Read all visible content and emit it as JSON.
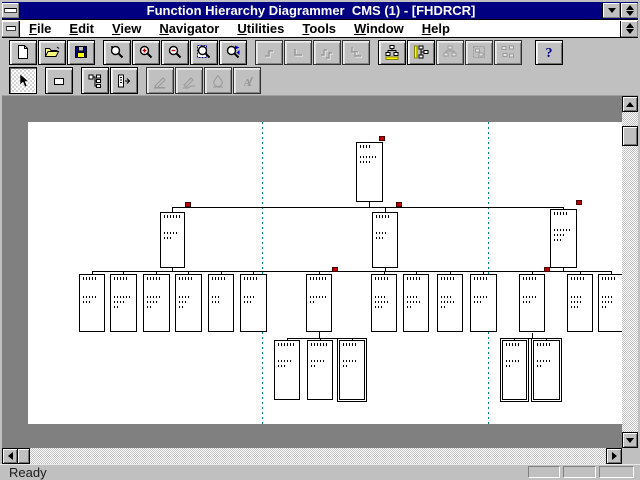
{
  "window": {
    "title": "Function Hierarchy Diagrammer  CMS (1) - [FHDRCR]"
  },
  "menu": {
    "items": [
      {
        "label": "File",
        "accel": 0
      },
      {
        "label": "Edit",
        "accel": 0
      },
      {
        "label": "View",
        "accel": 0
      },
      {
        "label": "Navigator",
        "accel": 0
      },
      {
        "label": "Utilities",
        "accel": 0
      },
      {
        "label": "Tools",
        "accel": 0
      },
      {
        "label": "Window",
        "accel": 0
      },
      {
        "label": "Help",
        "accel": 0
      }
    ]
  },
  "toolbar_row1": [
    {
      "name": "new",
      "icon": "doc-new",
      "enabled": true
    },
    {
      "name": "open",
      "icon": "folder-open",
      "enabled": true
    },
    {
      "name": "save",
      "icon": "floppy-save",
      "enabled": true
    },
    {
      "name": "zoom",
      "icon": "magnifier",
      "enabled": true,
      "gap": true
    },
    {
      "name": "zoom-in",
      "icon": "magnifier-plus",
      "enabled": true
    },
    {
      "name": "zoom-out",
      "icon": "magnifier-minus",
      "enabled": true
    },
    {
      "name": "zoom-page",
      "icon": "magnifier-page",
      "enabled": true
    },
    {
      "name": "zoom-navigator",
      "icon": "magnifier-nav",
      "enabled": true
    },
    {
      "name": "link-move",
      "icon": "link-bend",
      "enabled": false,
      "gap": true
    },
    {
      "name": "link-corner",
      "icon": "link-corner",
      "enabled": false
    },
    {
      "name": "link-move-all",
      "icon": "link-bend-multi",
      "enabled": false
    },
    {
      "name": "link-corner-all",
      "icon": "link-corner-multi",
      "enabled": false
    },
    {
      "name": "layout-horizontal",
      "icon": "layout-h",
      "enabled": true,
      "gap": true
    },
    {
      "name": "layout-vertical",
      "icon": "layout-v",
      "enabled": true
    },
    {
      "name": "layout-tree",
      "icon": "layout-tree",
      "enabled": false
    },
    {
      "name": "layout-selection",
      "icon": "layout-box",
      "enabled": false
    },
    {
      "name": "layout-all",
      "icon": "layout-grid",
      "enabled": false
    },
    {
      "name": "help",
      "icon": "help",
      "enabled": true,
      "gap": true,
      "bigGap": true
    }
  ],
  "toolbar_row2": [
    {
      "name": "select",
      "icon": "select-arrow",
      "enabled": true,
      "pressed": true
    },
    {
      "name": "draw-box",
      "icon": "rect-tool",
      "enabled": true,
      "gap": true
    },
    {
      "name": "expand-hierarchy",
      "icon": "tree-expand",
      "enabled": true,
      "gap": true
    },
    {
      "name": "collapse-hierarchy",
      "icon": "tree-collapse",
      "enabled": true
    },
    {
      "name": "edit-line",
      "icon": "pen-line",
      "enabled": false,
      "gap": true
    },
    {
      "name": "edit-polyline",
      "icon": "pen-polyline",
      "enabled": false
    },
    {
      "name": "edit-fill",
      "icon": "pen-fill",
      "enabled": false
    },
    {
      "name": "edit-text",
      "icon": "pen-text",
      "enabled": false
    }
  ],
  "status": {
    "ready": "Ready"
  },
  "diagram": {
    "marker_color": "#c00000",
    "guide_color": "#008080",
    "guides": [
      262,
      488
    ],
    "nodes": [
      {
        "x": 356,
        "y": 142,
        "w": 27,
        "h": 60,
        "head": 12,
        "bt": 8,
        "lines": [
          16,
          10
        ]
      },
      {
        "x": 160,
        "y": 212,
        "w": 25,
        "h": 56,
        "head": 16,
        "bt": 14,
        "lines": [
          15,
          9
        ]
      },
      {
        "x": 372,
        "y": 212,
        "w": 26,
        "h": 56,
        "head": 13,
        "bt": 14,
        "lines": [
          12,
          8
        ]
      },
      {
        "x": 550,
        "y": 209,
        "w": 27,
        "h": 59,
        "head": 15,
        "bt": 14,
        "lines": [
          16,
          12,
          7
        ]
      },
      {
        "x": 79,
        "y": 274,
        "w": 26,
        "h": 58,
        "head": 15,
        "bt": 16,
        "lines": [
          14,
          9
        ]
      },
      {
        "x": 110,
        "y": 274,
        "w": 27,
        "h": 58,
        "head": 14,
        "bt": 16,
        "lines": [
          16,
          10,
          6
        ]
      },
      {
        "x": 143,
        "y": 274,
        "w": 27,
        "h": 58,
        "head": 14,
        "bt": 16,
        "lines": [
          15,
          11,
          5
        ]
      },
      {
        "x": 175,
        "y": 274,
        "w": 27,
        "h": 58,
        "head": 14,
        "bt": 16,
        "lines": [
          10,
          8,
          6
        ]
      },
      {
        "x": 208,
        "y": 274,
        "w": 26,
        "h": 58,
        "head": 14,
        "bt": 16,
        "lines": [
          9,
          7
        ]
      },
      {
        "x": 240,
        "y": 274,
        "w": 27,
        "h": 58,
        "head": 15,
        "bt": 16,
        "lines": [
          12,
          8
        ]
      },
      {
        "x": 306,
        "y": 274,
        "w": 26,
        "h": 58,
        "head": 16,
        "bt": 16,
        "lines": [
          17,
          4
        ]
      },
      {
        "x": 371,
        "y": 274,
        "w": 26,
        "h": 58,
        "head": 15,
        "bt": 16,
        "lines": [
          10,
          13,
          8
        ]
      },
      {
        "x": 403,
        "y": 274,
        "w": 26,
        "h": 58,
        "head": 15,
        "bt": 16,
        "lines": [
          10,
          13,
          6
        ]
      },
      {
        "x": 437,
        "y": 274,
        "w": 26,
        "h": 58,
        "head": 15,
        "bt": 16,
        "lines": [
          10,
          13,
          5
        ]
      },
      {
        "x": 470,
        "y": 274,
        "w": 27,
        "h": 58,
        "head": 15,
        "bt": 16,
        "lines": [
          14,
          8
        ]
      },
      {
        "x": 519,
        "y": 274,
        "w": 26,
        "h": 58,
        "head": 15,
        "bt": 16,
        "lines": [
          13,
          7
        ]
      },
      {
        "x": 567,
        "y": 274,
        "w": 26,
        "h": 58,
        "head": 14,
        "bt": 16,
        "lines": [
          11,
          12,
          7
        ]
      },
      {
        "x": 598,
        "y": 274,
        "w": 26,
        "h": 58,
        "head": 14,
        "bt": 16,
        "lines": [
          11,
          10,
          4
        ]
      },
      {
        "x": 274,
        "y": 340,
        "w": 26,
        "h": 60,
        "head": 16,
        "bt": 14,
        "lines": [
          14,
          7
        ]
      },
      {
        "x": 307,
        "y": 340,
        "w": 26,
        "h": 60,
        "head": 16,
        "bt": 14,
        "lines": [
          14,
          6
        ]
      },
      {
        "x": 339,
        "y": 340,
        "w": 26,
        "h": 60,
        "head": 15,
        "bt": 14,
        "lines": [
          13,
          4
        ],
        "dbl": true
      },
      {
        "x": 502,
        "y": 340,
        "w": 25,
        "h": 60,
        "head": 14,
        "bt": 14,
        "lines": [
          15,
          6
        ],
        "dbl": true
      },
      {
        "x": 533,
        "y": 340,
        "w": 27,
        "h": 60,
        "head": 14,
        "bt": 14,
        "lines": [
          13,
          6
        ],
        "dbl": true
      }
    ],
    "edges": [
      [
        369,
        202,
        369,
        207
      ],
      [
        172,
        207,
        563,
        207
      ],
      [
        172,
        207,
        172,
        212
      ],
      [
        385,
        207,
        385,
        212
      ],
      [
        563,
        207,
        563,
        209
      ],
      [
        172,
        268,
        172,
        271
      ],
      [
        385,
        268,
        385,
        271
      ],
      [
        563,
        268,
        563,
        271
      ],
      [
        92,
        271,
        611,
        271
      ],
      [
        92,
        271,
        92,
        274
      ],
      [
        123,
        271,
        123,
        274
      ],
      [
        156,
        271,
        156,
        274
      ],
      [
        188,
        271,
        188,
        274
      ],
      [
        221,
        271,
        221,
        274
      ],
      [
        253,
        271,
        253,
        274
      ],
      [
        319,
        271,
        319,
        274
      ],
      [
        384,
        271,
        384,
        274
      ],
      [
        416,
        271,
        416,
        274
      ],
      [
        450,
        271,
        450,
        274
      ],
      [
        483,
        271,
        483,
        274
      ],
      [
        532,
        271,
        532,
        274
      ],
      [
        580,
        271,
        580,
        274
      ],
      [
        611,
        271,
        611,
        274
      ],
      [
        319,
        332,
        319,
        338
      ],
      [
        287,
        338,
        352,
        338
      ],
      [
        287,
        338,
        287,
        340
      ],
      [
        320,
        338,
        320,
        340
      ],
      [
        352,
        338,
        352,
        340
      ],
      [
        532,
        333,
        532,
        338
      ],
      [
        514,
        338,
        546,
        338
      ],
      [
        514,
        338,
        514,
        340
      ],
      [
        546,
        338,
        546,
        340
      ]
    ],
    "markers": [
      [
        379,
        136
      ],
      [
        185,
        202
      ],
      [
        396,
        202
      ],
      [
        576,
        200
      ],
      [
        332,
        267
      ],
      [
        544,
        267
      ]
    ]
  }
}
